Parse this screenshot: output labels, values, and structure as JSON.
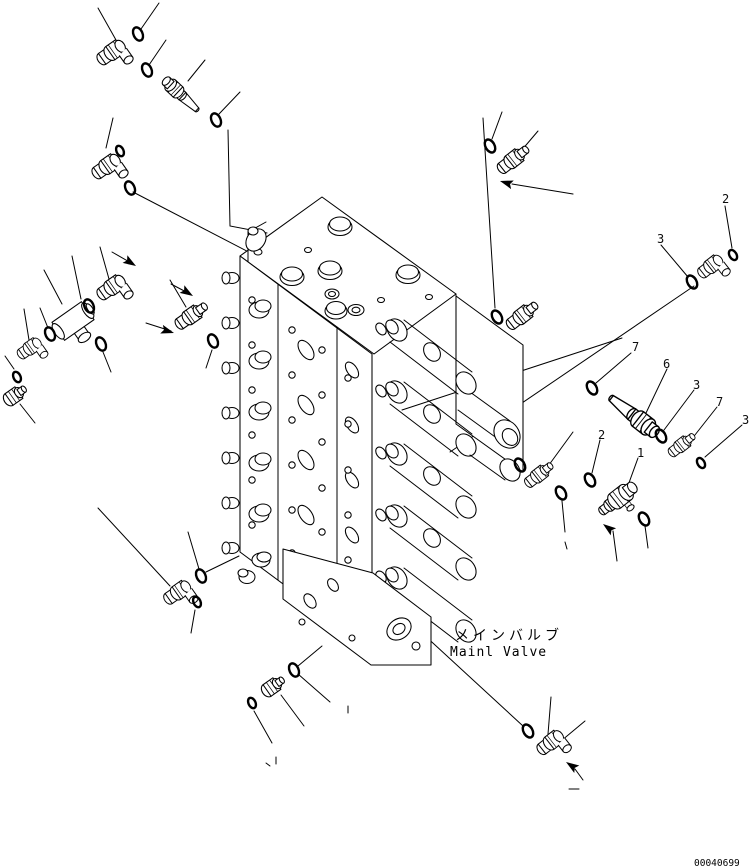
{
  "drawing": {
    "label_ja": "メインバルブ",
    "label_en": "Mainl Valve",
    "drawing_number": "00040699"
  },
  "colors": {
    "line": "#000000",
    "background": "#ffffff"
  },
  "component": "hydraulic-main-control-valve",
  "part_icons": [
    "main-valve-block",
    "o-ring",
    "fitting-elbow",
    "fitting-straight",
    "hex-plug",
    "stem-plug",
    "sensor-valve",
    "flow-arrow",
    "leader-line"
  ],
  "callouts": [
    {
      "label": "2",
      "x": 722,
      "y": 203
    },
    {
      "label": "3",
      "x": 657,
      "y": 243
    },
    {
      "label": "7",
      "x": 632,
      "y": 351
    },
    {
      "label": "6",
      "x": 663,
      "y": 368
    },
    {
      "label": "3",
      "x": 693,
      "y": 389
    },
    {
      "label": "7",
      "x": 716,
      "y": 406
    },
    {
      "label": "3",
      "x": 742,
      "y": 424
    },
    {
      "label": "2",
      "x": 598,
      "y": 439
    },
    {
      "label": "1",
      "x": 637,
      "y": 457
    }
  ]
}
